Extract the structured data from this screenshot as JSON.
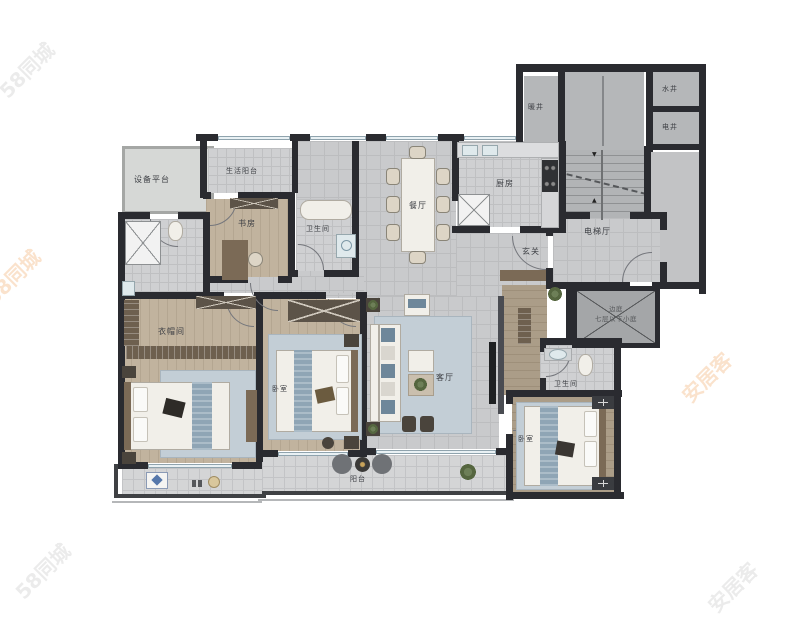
{
  "title": "户型图",
  "colors": {
    "wall": "#2a2b30",
    "tile_floor": "#c9cacc",
    "wood_floor": "#c1b39e",
    "rug_blue": "#c3ced6",
    "accent_blue": "#8fa5b5",
    "watermark_orange": "#ef9a4d",
    "watermark_gray": "#b9bab9"
  },
  "labels": {
    "equipment_platform": "设备平台",
    "service_balcony": "生活阳台",
    "study": "书房",
    "bath_main": "卫生间",
    "dining": "餐厅",
    "kitchen": "厨房",
    "foyer": "玄关",
    "elevator_hall": "电梯厅",
    "heating_shaft": "暖井",
    "water_shaft": "水井",
    "electric_shaft": "电井",
    "void_line1": "边庭",
    "void_line2": "七层以下小庭",
    "cloakroom": "衣帽间",
    "bedroom_mid": "卧室",
    "living": "客厅",
    "bath_second": "卫生间",
    "bedroom_right": "卧室",
    "balcony": "阳台"
  },
  "stairs": {
    "up_arrow": "▲",
    "down_arrow": "▼"
  },
  "watermarks": {
    "w1": "58同城",
    "w2": "58同城",
    "w3": "安居客",
    "w4": "58同城",
    "w5": "安居客"
  }
}
